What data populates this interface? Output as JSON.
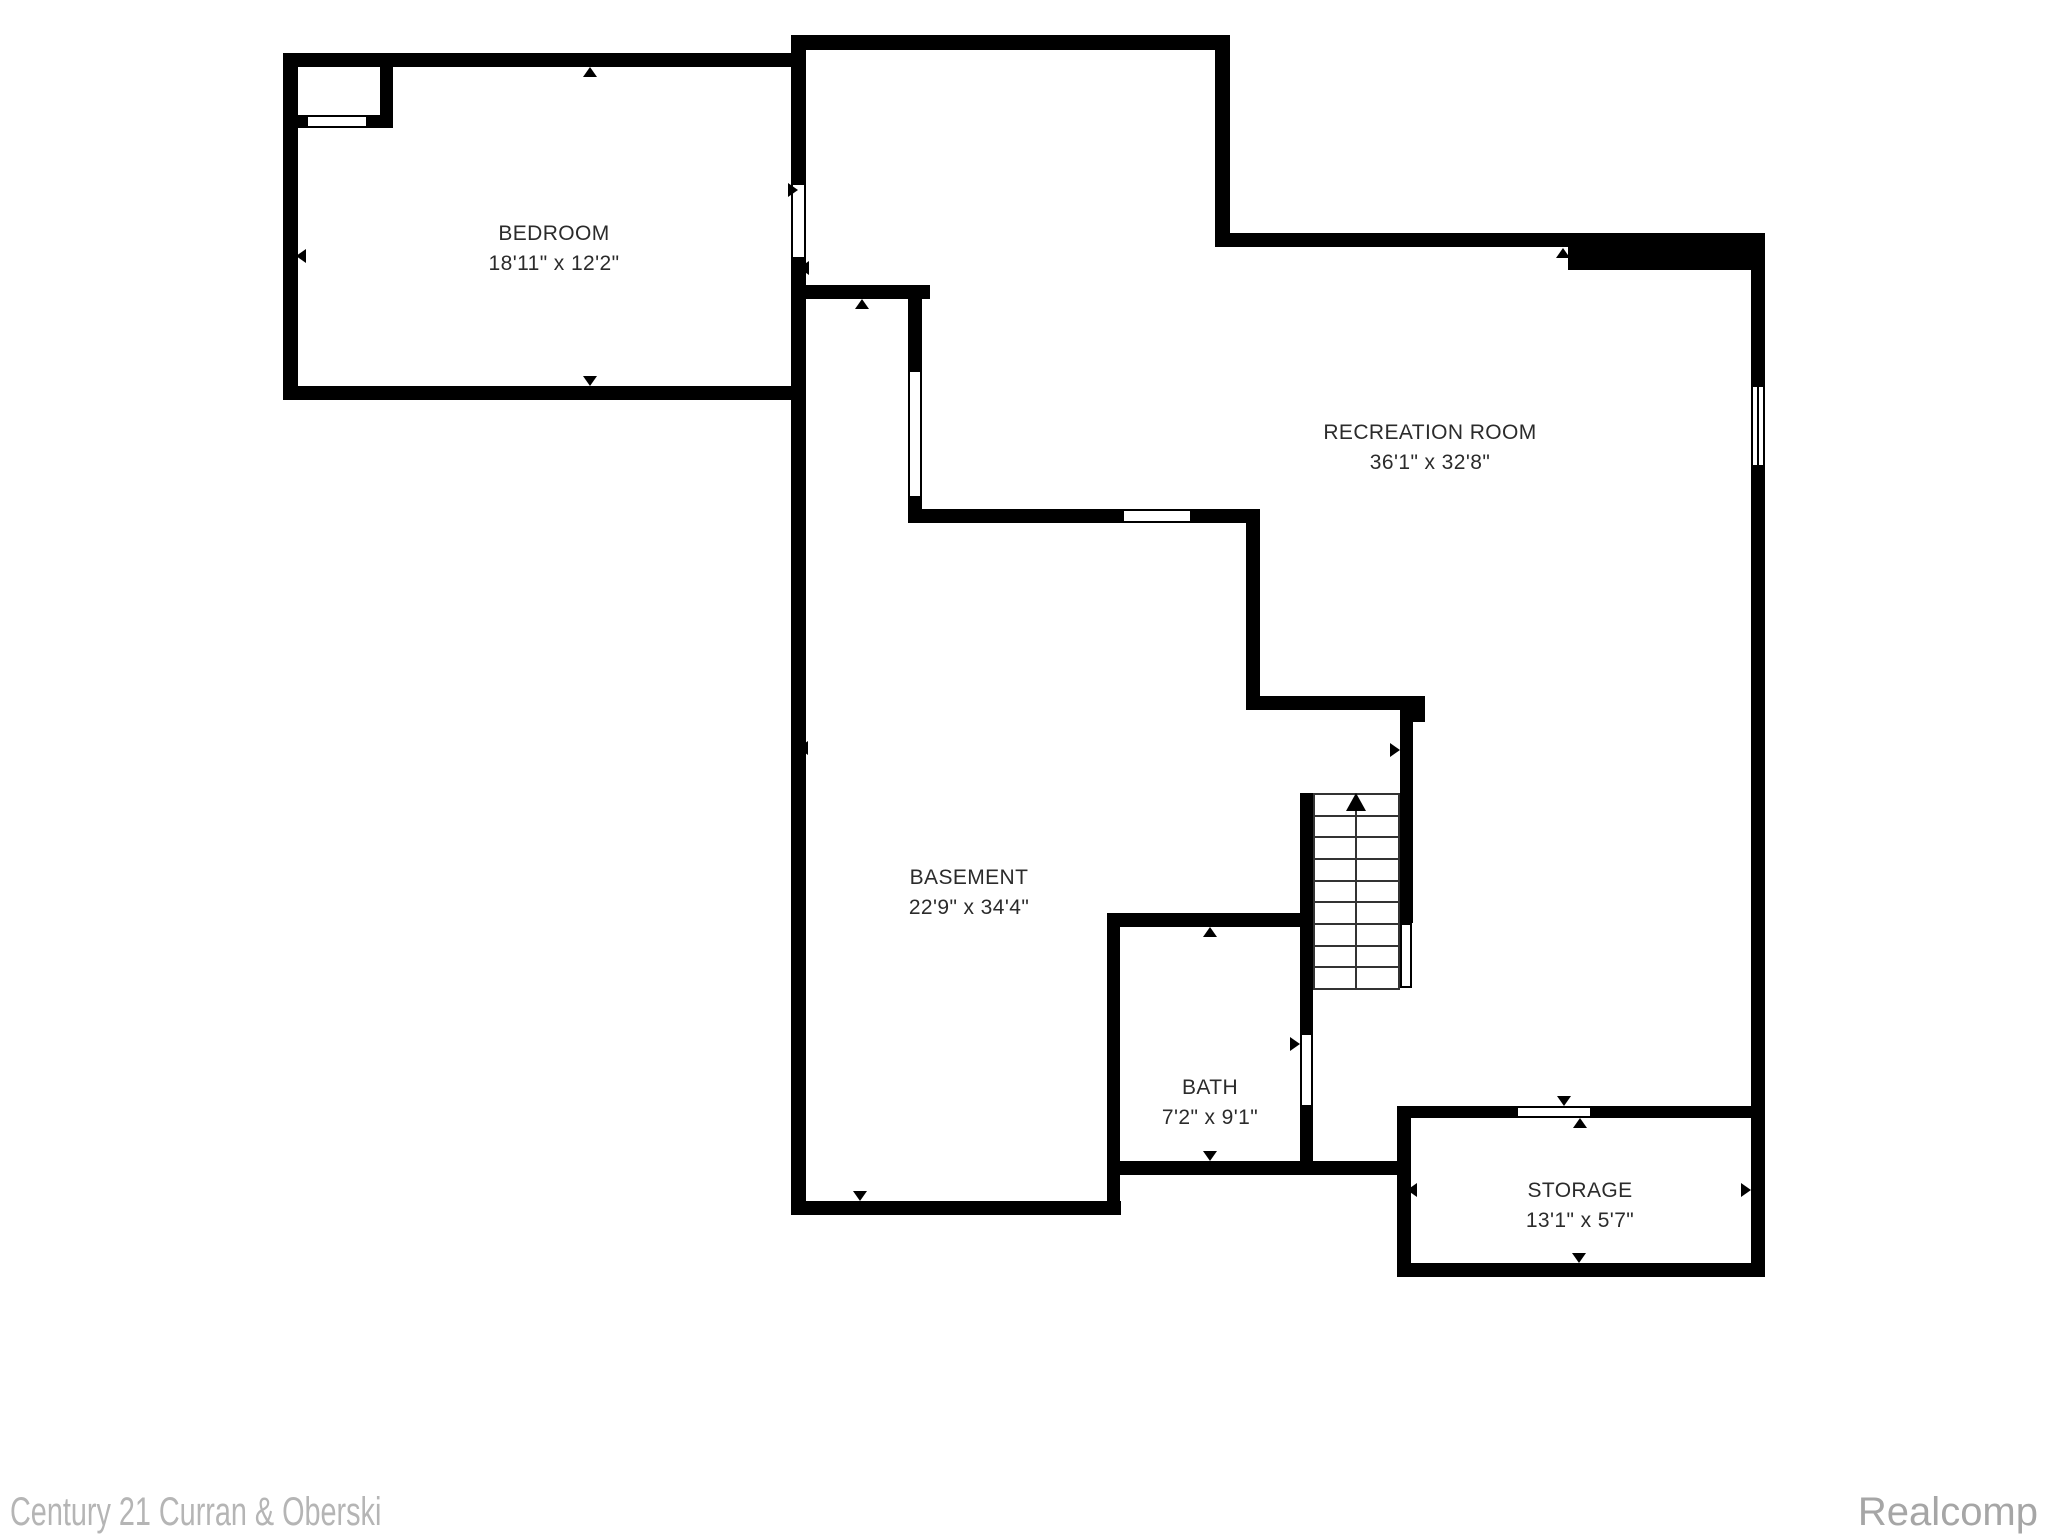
{
  "title": "Basement floor plan",
  "colors": {
    "wall": "#000000",
    "label_text": "#2b2b2b",
    "watermark_left": "#b5b5b5",
    "watermark_right": "#a6a6a6"
  },
  "watermarks": {
    "left": "Century 21 Curran & Oberski",
    "right": "Realcomp"
  },
  "floorplan": {
    "rooms": [
      {
        "id": "bedroom",
        "name": "BEDROOM",
        "dims": "18'11\" x 12'2\"",
        "cx": 554,
        "y": 219
      },
      {
        "id": "recreation-room",
        "name": "RECREATION ROOM",
        "dims": "36'1\" x 32'8\"",
        "cx": 1430,
        "y": 418
      },
      {
        "id": "basement",
        "name": "BASEMENT",
        "dims": "22'9\" x 34'4\"",
        "cx": 969,
        "y": 863
      },
      {
        "id": "bath",
        "name": "BATH",
        "dims": "7'2\" x 9'1\"",
        "cx": 1210,
        "y": 1073
      },
      {
        "id": "storage",
        "name": "STORAGE",
        "dims": "13'1\" x 5'7\"",
        "cx": 1580,
        "y": 1176
      }
    ],
    "walls": [
      [
        283,
        53,
        523,
        14
      ],
      [
        283,
        53,
        15,
        347
      ],
      [
        283,
        386,
        523,
        14
      ],
      [
        791,
        35,
        15,
        150
      ],
      [
        791,
        257,
        15,
        143
      ],
      [
        791,
        400,
        15,
        815
      ],
      [
        791,
        1201,
        330,
        14
      ],
      [
        791,
        35,
        439,
        15
      ],
      [
        1215,
        50,
        15,
        197
      ],
      [
        1215,
        233,
        353,
        14
      ],
      [
        1568,
        233,
        197,
        37
      ],
      [
        1751,
        233,
        14,
        1044
      ],
      [
        1397,
        1263,
        368,
        14
      ],
      [
        1397,
        1106,
        14,
        171
      ],
      [
        1397,
        1106,
        121,
        12
      ],
      [
        1590,
        1106,
        161,
        12
      ],
      [
        380,
        67,
        13,
        61
      ],
      [
        298,
        115,
        8,
        13
      ],
      [
        368,
        115,
        25,
        13
      ],
      [
        806,
        285,
        124,
        14
      ],
      [
        908,
        299,
        14,
        71
      ],
      [
        908,
        498,
        14,
        24
      ],
      [
        908,
        509,
        214,
        14
      ],
      [
        1192,
        509,
        68,
        14
      ],
      [
        1246,
        509,
        14,
        201
      ],
      [
        1246,
        696,
        164,
        14
      ],
      [
        1400,
        696,
        25,
        26
      ],
      [
        1400,
        722,
        13,
        201
      ],
      [
        1300,
        793,
        13,
        242
      ],
      [
        1107,
        913,
        206,
        14
      ],
      [
        1107,
        913,
        13,
        302
      ],
      [
        1107,
        1161,
        290,
        14
      ],
      [
        1300,
        1105,
        13,
        70
      ]
    ],
    "openings": [
      {
        "name": "closet-door-opening",
        "x": 306,
        "y": 115,
        "w": 62,
        "h": 13,
        "style": "outline"
      },
      {
        "name": "bedroom-door-opening",
        "x": 791,
        "y": 185,
        "w": 15,
        "h": 72,
        "style": "gap-v"
      },
      {
        "name": "basement-window",
        "x": 908,
        "y": 370,
        "w": 14,
        "h": 128,
        "style": "outline"
      },
      {
        "name": "recreation-window-small",
        "x": 1122,
        "y": 509,
        "w": 70,
        "h": 14,
        "style": "outline"
      },
      {
        "name": "recreation-window-right",
        "x": 1751,
        "y": 385,
        "w": 14,
        "h": 82,
        "style": "window-v"
      },
      {
        "name": "storage-door-opening",
        "x": 1518,
        "y": 1106,
        "w": 72,
        "h": 12,
        "style": "gap-h"
      },
      {
        "name": "bath-door-opening",
        "x": 1300,
        "y": 1035,
        "w": 13,
        "h": 70,
        "style": "gap-v"
      },
      {
        "name": "stair-railing",
        "x": 1400,
        "y": 923,
        "w": 12,
        "h": 65,
        "style": "outline"
      }
    ],
    "markers": [
      {
        "x": 583,
        "y": 67,
        "dir": "up"
      },
      {
        "x": 296,
        "y": 249,
        "dir": "left"
      },
      {
        "x": 583,
        "y": 376,
        "dir": "down"
      },
      {
        "x": 855,
        "y": 299,
        "dir": "up"
      },
      {
        "x": 788,
        "y": 183,
        "dir": "right"
      },
      {
        "x": 799,
        "y": 261,
        "dir": "left"
      },
      {
        "x": 1556,
        "y": 248,
        "dir": "up"
      },
      {
        "x": 1390,
        "y": 743,
        "dir": "right"
      },
      {
        "x": 1290,
        "y": 1037,
        "dir": "right"
      },
      {
        "x": 1203,
        "y": 927,
        "dir": "up"
      },
      {
        "x": 1110,
        "y": 1036,
        "dir": "left"
      },
      {
        "x": 1203,
        "y": 1151,
        "dir": "down"
      },
      {
        "x": 1407,
        "y": 1183,
        "dir": "left"
      },
      {
        "x": 1741,
        "y": 1183,
        "dir": "right"
      },
      {
        "x": 1572,
        "y": 1253,
        "dir": "down"
      },
      {
        "x": 1557,
        "y": 1096,
        "dir": "down"
      },
      {
        "x": 1573,
        "y": 1118,
        "dir": "up"
      },
      {
        "x": 798,
        "y": 741,
        "dir": "left"
      },
      {
        "x": 853,
        "y": 1191,
        "dir": "down"
      }
    ],
    "stairs": {
      "x": 1313,
      "w": 87,
      "y_top": 793,
      "y_bottom": 988,
      "tread_lines": 10,
      "center_x": 1356,
      "direction": "up"
    }
  }
}
